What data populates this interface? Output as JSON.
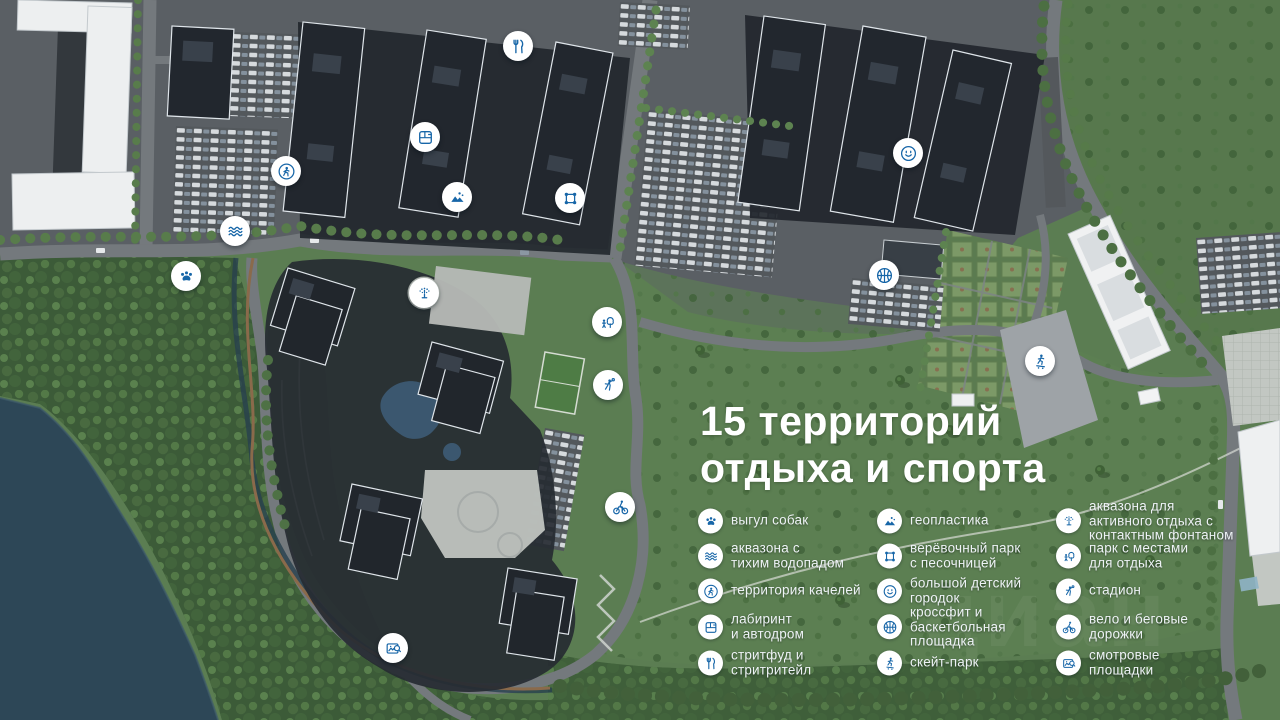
{
  "title": {
    "lines": [
      "15 территорий",
      "отдыха и спорта"
    ]
  },
  "watermark": "циан",
  "colors": {
    "icon_blue": "#1766a8",
    "marker_bg": "#ffffff",
    "title_text": "#ffffff",
    "water": "#2d4757",
    "meadow_green": "#5b7d52",
    "forest_green": "#3c5b38",
    "asphalt": "#5a5f64",
    "dark_building": "#22272e",
    "white_building": "#edeff0"
  },
  "legend": {
    "columns": [
      {
        "items": [
          {
            "icon": "paw-icon",
            "lines": [
              "выгул собак"
            ]
          },
          {
            "icon": "waves-icon",
            "lines": [
              "аквазона с",
              "тихим водопадом"
            ]
          },
          {
            "icon": "walking-person-icon",
            "lines": [
              "территория качелей"
            ]
          },
          {
            "icon": "maze-icon",
            "lines": [
              "лабиринт",
              "и автодром"
            ]
          },
          {
            "icon": "streetfood-icon",
            "lines": [
              "стритфуд и",
              "стритритейл"
            ]
          }
        ]
      },
      {
        "items": [
          {
            "icon": "geoplastics-icon",
            "lines": [
              "геопластика"
            ]
          },
          {
            "icon": "rope-park-icon",
            "lines": [
              "верёвочный парк",
              "с песочницей"
            ]
          },
          {
            "icon": "smiley-icon",
            "lines": [
              "большой детский",
              "городок"
            ]
          },
          {
            "icon": "basketball-icon",
            "lines": [
              "кроссфит и",
              "баскетбольная",
              "площадка"
            ]
          },
          {
            "icon": "skatepark-icon",
            "lines": [
              "скейт-парк"
            ]
          }
        ]
      },
      {
        "items": [
          {
            "icon": "fountain-icon",
            "lines": [
              "аквазона для",
              "активного отдыха с",
              "контактным фонтаном"
            ]
          },
          {
            "icon": "park-icon",
            "lines": [
              "парк с местами",
              "для отдыха"
            ]
          },
          {
            "icon": "stadium-icon",
            "lines": [
              "стадион"
            ]
          },
          {
            "icon": "bike-icon",
            "lines": [
              "вело и беговые",
              "дорожки"
            ]
          },
          {
            "icon": "viewpoint-icon",
            "lines": [
              "смотровые",
              "площадки"
            ]
          }
        ]
      }
    ]
  },
  "markers": [
    {
      "icon": "streetfood-icon",
      "x": 518,
      "y": 46
    },
    {
      "icon": "maze-icon",
      "x": 425,
      "y": 137
    },
    {
      "icon": "walking-person-icon",
      "x": 286,
      "y": 171
    },
    {
      "icon": "geoplastics-icon",
      "x": 457,
      "y": 197
    },
    {
      "icon": "rope-park-icon",
      "x": 570,
      "y": 198
    },
    {
      "icon": "waves-icon",
      "x": 235,
      "y": 231
    },
    {
      "icon": "paw-icon",
      "x": 186,
      "y": 276
    },
    {
      "icon": "smiley-icon",
      "x": 908,
      "y": 153
    },
    {
      "icon": "basketball-icon",
      "x": 884,
      "y": 275
    },
    {
      "icon": "fountain-icon",
      "x": 424,
      "y": 293
    },
    {
      "icon": "park-icon",
      "x": 607,
      "y": 322
    },
    {
      "icon": "stadium-icon",
      "x": 608,
      "y": 385
    },
    {
      "icon": "skatepark-icon",
      "x": 1040,
      "y": 361
    },
    {
      "icon": "bike-icon",
      "x": 620,
      "y": 507
    },
    {
      "icon": "viewpoint-icon",
      "x": 393,
      "y": 648
    }
  ]
}
